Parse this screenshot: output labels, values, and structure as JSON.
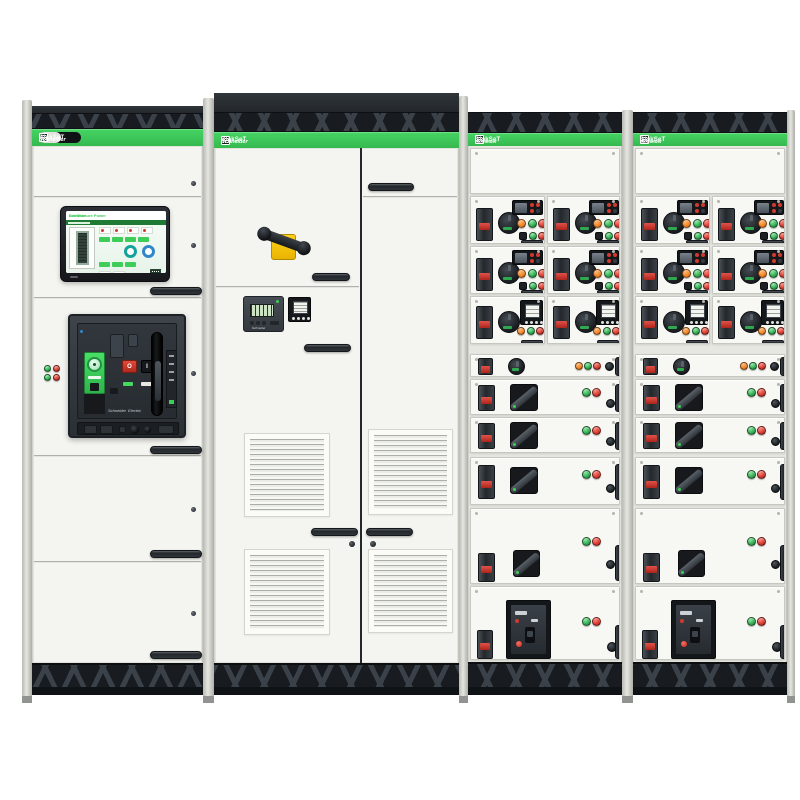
{
  "brand": {
    "logo_line1": "Schneider",
    "logo_line2": "Electric",
    "range": "BlokSeT"
  },
  "hmi": {
    "title": "EcoStruxure Power"
  },
  "main_breaker": {
    "off_label": "O",
    "on_label": "I"
  },
  "colors": {
    "brand_green": "#3DCD58",
    "chassis_dark": "#23272C",
    "panel_white": "#F5F5F1",
    "pilot_red": "#D2382E",
    "pilot_green": "#2FA84F",
    "pilot_orange": "#F08223",
    "handle_yellow": "#F5C400",
    "gauge_teal": "#14A39A",
    "gauge_blue": "#2F86C9",
    "lcd_green": "#CDE4C4"
  },
  "cabinets": [
    {
      "id": "cabinet-1",
      "role": "incomer-column"
    },
    {
      "id": "cabinet-2",
      "role": "ventilated-coupling-column"
    },
    {
      "id": "cabinet-3",
      "role": "drawer-column"
    },
    {
      "id": "cabinet-4",
      "role": "drawer-column"
    }
  ]
}
